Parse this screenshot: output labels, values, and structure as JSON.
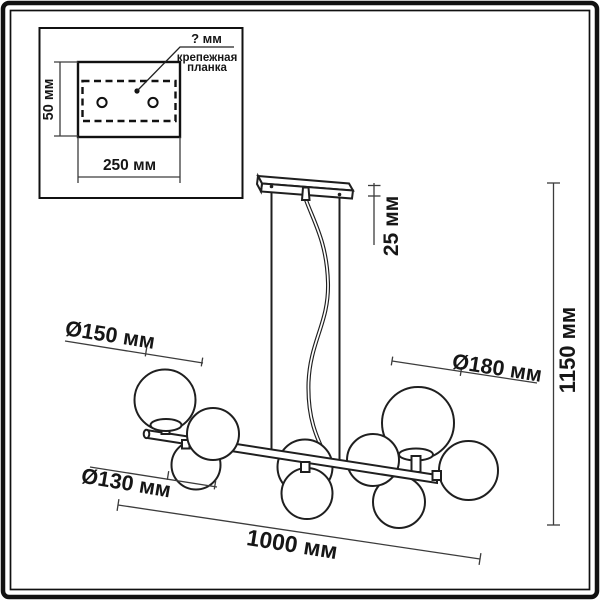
{
  "page": {
    "background": "#ffffff",
    "line_color": "#1f1f1f",
    "dimension_color": "#3c3c3c"
  },
  "inset": {
    "hole_dim_label": "? мм",
    "plate_label_line1": "крепежная",
    "plate_label_line2": "планка",
    "height_label": "50 мм",
    "width_label": "250 мм"
  },
  "dimensions": {
    "canopy_drop": "25 мм",
    "total_height": "1150 мм",
    "globe_large": "Ø150 мм",
    "globe_xlarge": "Ø180 мм",
    "globe_small": "Ø130 мм",
    "total_length": "1000 мм"
  }
}
